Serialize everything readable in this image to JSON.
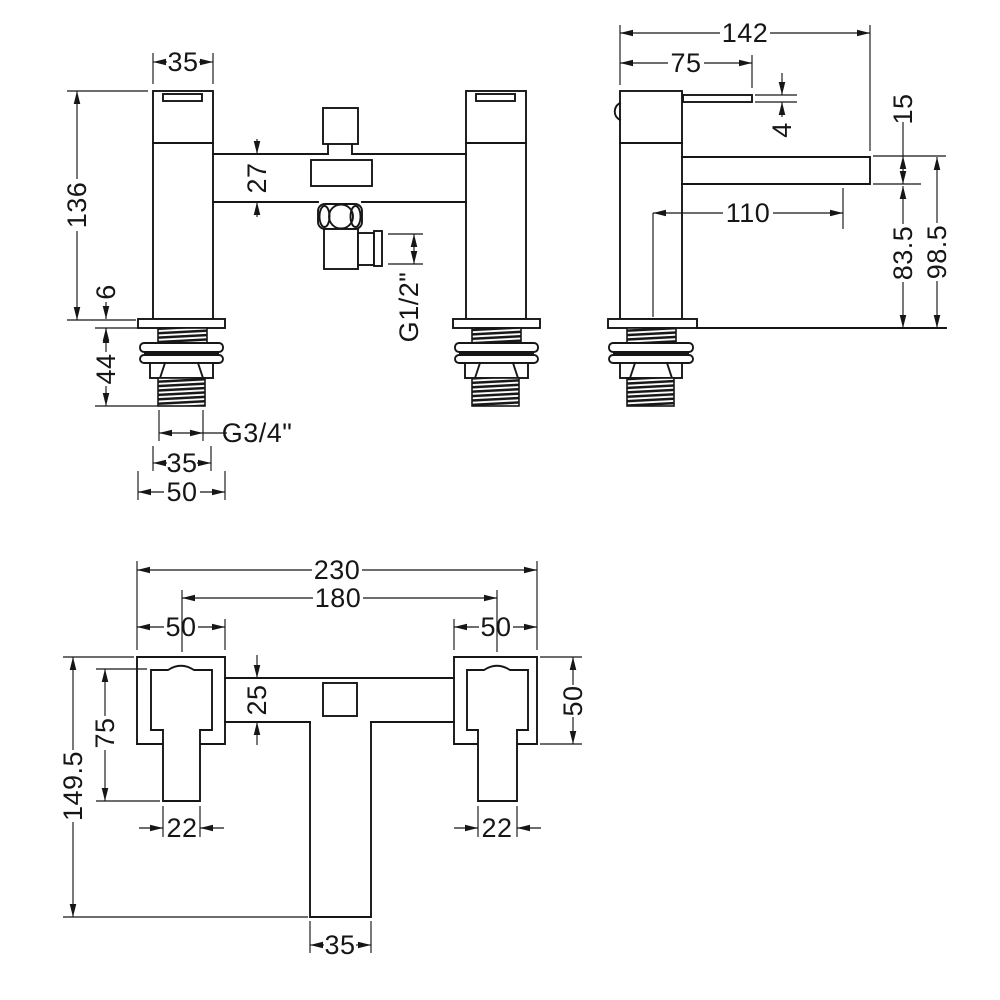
{
  "drawing": {
    "kind": "technical-dimension-drawing",
    "subject": "deck mounted bath shower mixer tap - dimensioned orthographic views",
    "views": [
      {
        "id": "front",
        "name": "front-elevation"
      },
      {
        "id": "side",
        "name": "side-elevation"
      },
      {
        "id": "plan",
        "name": "plan-view"
      }
    ]
  },
  "colors": {
    "background": "#ffffff",
    "line": "#161616"
  },
  "dimensions": [
    {
      "id": "front-top-width",
      "view": "front",
      "label": "35",
      "lx": 183,
      "ly": 62,
      "rot": false,
      "segs": [
        [
          153,
          62,
          167,
          62
        ],
        [
          199,
          62,
          213,
          62
        ]
      ],
      "arrows": [
        [
          153,
          62,
          180
        ],
        [
          213,
          62,
          0
        ]
      ],
      "exts": [
        [
          153,
          84,
          153,
          53
        ],
        [
          213,
          84,
          213,
          53
        ]
      ]
    },
    {
      "id": "front-height",
      "view": "front",
      "label": "136",
      "lx": 77,
      "ly": 205,
      "rot": true,
      "segs": [
        [
          77,
          91,
          77,
          179
        ],
        [
          77,
          231,
          77,
          320
        ]
      ],
      "arrows": [
        [
          77,
          91,
          270
        ],
        [
          77,
          320,
          90
        ]
      ],
      "exts": [
        [
          148,
          91,
          67,
          91
        ],
        [
          136,
          320,
          67,
          320
        ]
      ]
    },
    {
      "id": "front-crossbar-height",
      "view": "front",
      "label": "27",
      "lx": 257,
      "ly": 178,
      "rot": true,
      "segs": [
        [
          257,
          139,
          257,
          154
        ],
        [
          257,
          202,
          257,
          217
        ]
      ],
      "arrows": [
        [
          257,
          154,
          90
        ],
        [
          257,
          202,
          270
        ]
      ],
      "exts": []
    },
    {
      "id": "front-plate-thickness",
      "view": "front",
      "label": "6",
      "lx": 106,
      "ly": 292,
      "rot": true,
      "segs": [
        [
          106,
          302,
          106,
          319
        ],
        [
          106,
          328,
          106,
          341
        ]
      ],
      "arrows": [
        [
          106,
          319,
          90
        ],
        [
          106,
          328,
          270
        ]
      ],
      "exts": [
        [
          138,
          328,
          95,
          328
        ]
      ]
    },
    {
      "id": "front-thread-length",
      "view": "front",
      "label": "44",
      "lx": 106,
      "ly": 369,
      "rot": true,
      "segs": [
        [
          106,
          329,
          106,
          352
        ],
        [
          106,
          386,
          106,
          406
        ]
      ],
      "arrows": [
        [
          106,
          330,
          270
        ],
        [
          106,
          406,
          90
        ]
      ],
      "exts": [
        [
          158,
          406,
          95,
          406
        ]
      ]
    },
    {
      "id": "front-inlet-thread",
      "view": "front",
      "label": "G3/4\"",
      "lx": 257,
      "ly": 433,
      "rot": false,
      "segs": [
        [
          159,
          433,
          203,
          433
        ],
        [
          203,
          433,
          227,
          433
        ]
      ],
      "arrows": [
        [
          159,
          433,
          180
        ],
        [
          203,
          433,
          0
        ]
      ],
      "exts": [
        [
          159,
          410,
          159,
          441
        ],
        [
          203,
          410,
          203,
          441
        ]
      ]
    },
    {
      "id": "front-thread-width",
      "view": "front",
      "label": "35",
      "lx": 182,
      "ly": 463,
      "rot": false,
      "segs": [
        [
          153,
          463,
          167,
          463
        ],
        [
          197,
          463,
          211,
          463
        ]
      ],
      "arrows": [
        [
          153,
          463,
          180
        ],
        [
          211,
          463,
          0
        ]
      ],
      "exts": [
        [
          153,
          446,
          153,
          471
        ],
        [
          211,
          446,
          211,
          471
        ]
      ]
    },
    {
      "id": "front-plate-width",
      "view": "front",
      "label": "50",
      "lx": 182,
      "ly": 492,
      "rot": false,
      "segs": [
        [
          138,
          492,
          164,
          492
        ],
        [
          200,
          492,
          225,
          492
        ]
      ],
      "arrows": [
        [
          138,
          492,
          180
        ],
        [
          225,
          492,
          0
        ]
      ],
      "exts": [
        [
          138,
          471,
          138,
          500
        ],
        [
          225,
          471,
          225,
          500
        ]
      ]
    },
    {
      "id": "front-outlet-thread",
      "view": "front",
      "label": "G1/2\"",
      "lx": 409,
      "ly": 307,
      "rot": true,
      "segs": [
        [
          414,
          234,
          414,
          264
        ]
      ],
      "arrows": [
        [
          414,
          234,
          270
        ],
        [
          414,
          264,
          90
        ]
      ],
      "exts": [
        [
          388,
          234,
          423,
          234
        ],
        [
          388,
          264,
          423,
          264
        ]
      ]
    },
    {
      "id": "side-depth",
      "view": "side",
      "label": "142",
      "lx": 745,
      "ly": 33,
      "rot": false,
      "segs": [
        [
          620,
          33,
          720,
          33
        ],
        [
          770,
          33,
          870,
          33
        ]
      ],
      "arrows": [
        [
          620,
          33,
          180
        ],
        [
          870,
          33,
          0
        ]
      ],
      "exts": [
        [
          620,
          85,
          620,
          25
        ],
        [
          870,
          151,
          870,
          25
        ]
      ]
    },
    {
      "id": "side-handle-depth",
      "view": "side",
      "label": "75",
      "lx": 686,
      "ly": 63,
      "rot": false,
      "segs": [
        [
          620,
          63,
          668,
          63
        ],
        [
          704,
          63,
          752,
          63
        ]
      ],
      "arrows": [
        [
          620,
          63,
          180
        ],
        [
          752,
          63,
          0
        ]
      ],
      "exts": [
        [
          752,
          88,
          752,
          55
        ]
      ]
    },
    {
      "id": "side-lever-thickness",
      "view": "side",
      "label": "4",
      "lx": 782,
      "ly": 130,
      "rot": true,
      "segs": [
        [
          782,
          73,
          782,
          95
        ],
        [
          782,
          102,
          782,
          117
        ]
      ],
      "arrows": [
        [
          782,
          95,
          90
        ],
        [
          782,
          102,
          270
        ]
      ],
      "exts": [
        [
          755,
          95,
          797,
          95
        ],
        [
          755,
          102,
          797,
          102
        ]
      ]
    },
    {
      "id": "side-spout-reach",
      "view": "side",
      "label": "110",
      "lx": 748,
      "ly": 213,
      "rot": false,
      "segs": [
        [
          653,
          213,
          723,
          213
        ],
        [
          773,
          213,
          843,
          213
        ]
      ],
      "arrows": [
        [
          653,
          213,
          180
        ],
        [
          843,
          213,
          0
        ]
      ],
      "exts": [
        [
          653,
          213,
          653,
          317
        ],
        [
          843,
          188,
          843,
          229
        ]
      ]
    },
    {
      "id": "side-spout-height",
      "view": "side",
      "label": "15",
      "lx": 903,
      "ly": 109,
      "rot": true,
      "segs": [
        [
          903,
          122,
          903,
          184
        ]
      ],
      "arrows": [
        [
          903,
          156,
          270
        ],
        [
          903,
          184,
          90
        ]
      ],
      "exts": [
        [
          873,
          156,
          946,
          156
        ],
        [
          873,
          184,
          921,
          184
        ]
      ]
    },
    {
      "id": "side-spout-bottom-height",
      "view": "side",
      "label": "83.5",
      "lx": 903,
      "ly": 253,
      "rot": true,
      "segs": [
        [
          903,
          186,
          903,
          224
        ],
        [
          903,
          282,
          903,
          328
        ]
      ],
      "arrows": [
        [
          903,
          186,
          270
        ],
        [
          903,
          328,
          90
        ]
      ],
      "exts": []
    },
    {
      "id": "side-spout-top-height",
      "view": "side",
      "label": "98.5",
      "lx": 937,
      "ly": 252,
      "rot": true,
      "segs": [
        [
          937,
          157,
          937,
          223
        ],
        [
          937,
          281,
          937,
          328
        ]
      ],
      "arrows": [
        [
          937,
          157,
          270
        ],
        [
          937,
          328,
          90
        ]
      ],
      "exts": []
    },
    {
      "id": "plan-overall-width",
      "view": "plan",
      "label": "230",
      "lx": 337,
      "ly": 570,
      "rot": false,
      "segs": [
        [
          137,
          570,
          312,
          570
        ],
        [
          362,
          570,
          537,
          570
        ]
      ],
      "arrows": [
        [
          137,
          570,
          180
        ],
        [
          537,
          570,
          0
        ]
      ],
      "exts": [
        [
          137,
          650,
          137,
          561
        ],
        [
          537,
          650,
          537,
          561
        ]
      ]
    },
    {
      "id": "plan-hole-centres",
      "view": "plan",
      "label": "180",
      "lx": 338,
      "ly": 598,
      "rot": false,
      "segs": [
        [
          182,
          598,
          313,
          598
        ],
        [
          363,
          598,
          497,
          598
        ]
      ],
      "arrows": [
        [
          182,
          598,
          180
        ],
        [
          497,
          598,
          0
        ]
      ],
      "exts": [
        [
          182,
          652,
          182,
          590
        ],
        [
          497,
          652,
          497,
          590
        ]
      ]
    },
    {
      "id": "plan-left-flange-width",
      "view": "plan",
      "label": "50",
      "lx": 181,
      "ly": 627,
      "rot": false,
      "segs": [
        [
          137,
          627,
          164,
          627
        ],
        [
          198,
          627,
          225,
          627
        ]
      ],
      "arrows": [
        [
          137,
          627,
          180
        ],
        [
          225,
          627,
          0
        ]
      ],
      "exts": [
        [
          225,
          650,
          225,
          619
        ]
      ]
    },
    {
      "id": "plan-right-flange-width",
      "view": "plan",
      "label": "50",
      "lx": 496,
      "ly": 627,
      "rot": false,
      "segs": [
        [
          454,
          627,
          479,
          627
        ],
        [
          513,
          627,
          537,
          627
        ]
      ],
      "arrows": [
        [
          454,
          627,
          180
        ],
        [
          537,
          627,
          0
        ]
      ],
      "exts": [
        [
          454,
          650,
          454,
          619
        ]
      ]
    },
    {
      "id": "plan-crossbody-depth",
      "view": "plan",
      "label": "25",
      "lx": 257,
      "ly": 700,
      "rot": true,
      "segs": [
        [
          257,
          655,
          257,
          678
        ],
        [
          257,
          722,
          257,
          745
        ]
      ],
      "arrows": [
        [
          257,
          678,
          90
        ],
        [
          257,
          722,
          270
        ]
      ],
      "exts": []
    },
    {
      "id": "plan-handle-length",
      "view": "plan",
      "label": "75",
      "lx": 105,
      "ly": 733,
      "rot": true,
      "segs": [
        [
          105,
          669,
          105,
          716
        ],
        [
          105,
          750,
          105,
          801
        ]
      ],
      "arrows": [
        [
          105,
          669,
          270
        ],
        [
          105,
          801,
          90
        ]
      ],
      "exts": [
        [
          147,
          669,
          96,
          669
        ],
        [
          160,
          801,
          96,
          801
        ]
      ]
    },
    {
      "id": "plan-overall-depth",
      "view": "plan",
      "label": "149.5",
      "lx": 73,
      "ly": 786,
      "rot": true,
      "segs": [
        [
          73,
          657,
          73,
          750
        ],
        [
          73,
          822,
          73,
          917
        ]
      ],
      "arrows": [
        [
          73,
          657,
          270
        ],
        [
          73,
          917,
          90
        ]
      ],
      "exts": [
        [
          134,
          657,
          63,
          657
        ],
        [
          308,
          917,
          63,
          917
        ]
      ]
    },
    {
      "id": "plan-left-handle-width",
      "view": "plan",
      "label": "22",
      "lx": 182,
      "ly": 828,
      "rot": false,
      "segs": [
        [
          139,
          828,
          163,
          828
        ],
        [
          200,
          828,
          224,
          828
        ]
      ],
      "arrows": [
        [
          163,
          828,
          0
        ],
        [
          200,
          828,
          180
        ]
      ],
      "exts": [
        [
          163,
          806,
          163,
          837
        ],
        [
          200,
          806,
          200,
          837
        ]
      ]
    },
    {
      "id": "plan-right-handle-width",
      "view": "plan",
      "label": "22",
      "lx": 497,
      "ly": 828,
      "rot": false,
      "segs": [
        [
          454,
          828,
          478,
          828
        ],
        [
          517,
          828,
          541,
          828
        ]
      ],
      "arrows": [
        [
          478,
          828,
          0
        ],
        [
          517,
          828,
          180
        ]
      ],
      "exts": [
        [
          478,
          806,
          478,
          837
        ],
        [
          517,
          806,
          517,
          837
        ]
      ]
    },
    {
      "id": "plan-flange-depth",
      "view": "plan",
      "label": "50",
      "lx": 573,
      "ly": 701,
      "rot": true,
      "segs": [
        [
          573,
          657,
          573,
          685
        ],
        [
          573,
          717,
          573,
          744
        ]
      ],
      "arrows": [
        [
          573,
          657,
          270
        ],
        [
          573,
          744,
          90
        ]
      ],
      "exts": [
        [
          540,
          657,
          582,
          657
        ],
        [
          540,
          744,
          582,
          744
        ]
      ]
    },
    {
      "id": "plan-spout-width",
      "view": "plan",
      "label": "35",
      "lx": 340,
      "ly": 945,
      "rot": false,
      "segs": [
        [
          310,
          945,
          324,
          945
        ],
        [
          356,
          945,
          371,
          945
        ]
      ],
      "arrows": [
        [
          310,
          945,
          180
        ],
        [
          371,
          945,
          0
        ]
      ],
      "exts": [
        [
          310,
          921,
          310,
          953
        ],
        [
          371,
          921,
          371,
          953
        ]
      ]
    }
  ]
}
